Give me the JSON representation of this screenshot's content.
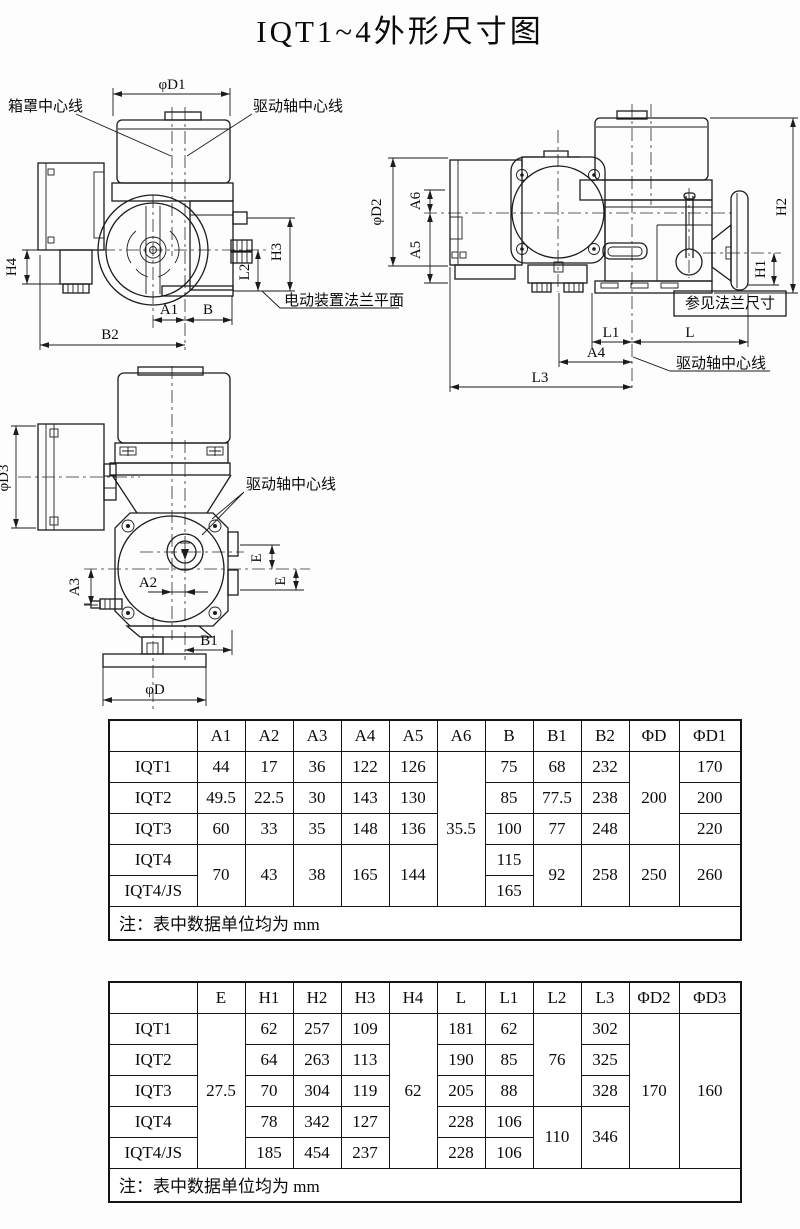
{
  "title": "IQT1~4外形尺寸图",
  "drawing": {
    "front": {
      "d1": "φD1",
      "box_centerline": "箱罩中心线",
      "shaft_centerline": "驱动轴中心线",
      "h4": "H4",
      "h3": "H3",
      "l2": "L2",
      "a1": "A1",
      "b": "B",
      "b2": "B2",
      "flange_plane": "电动装置法兰平面"
    },
    "side": {
      "d2": "φD2",
      "a6": "A6",
      "a5": "A5",
      "h2": "H2",
      "h1": "H1",
      "see_flange": "参见法兰尺寸",
      "l1": "L1",
      "l": "L",
      "a4": "A4",
      "l3": "L3",
      "shaft_centerline": "驱动轴中心线"
    },
    "top": {
      "d3": "φD3",
      "shaft_centerline": "驱动轴中心线",
      "e_upper": "E",
      "e_lower": "E",
      "a3": "A3",
      "a2": "A2",
      "b1": "B1",
      "d": "φD"
    }
  },
  "table1": {
    "headers": [
      "",
      "A1",
      "A2",
      "A3",
      "A4",
      "A5",
      "A6",
      "B",
      "B1",
      "B2",
      "ΦD",
      "ΦD1"
    ],
    "rows": [
      [
        {
          "v": "IQT1"
        },
        {
          "v": "44"
        },
        {
          "v": "17"
        },
        {
          "v": "36"
        },
        {
          "v": "122"
        },
        {
          "v": "126"
        },
        {
          "v": "35.5",
          "rs": 5
        },
        {
          "v": "75"
        },
        {
          "v": "68"
        },
        {
          "v": "232"
        },
        {
          "v": "200",
          "rs": 3
        },
        {
          "v": "170"
        }
      ],
      [
        {
          "v": "IQT2"
        },
        {
          "v": "49.5"
        },
        {
          "v": "22.5"
        },
        {
          "v": "30"
        },
        {
          "v": "143"
        },
        {
          "v": "130"
        },
        {
          "v": "85"
        },
        {
          "v": "77.5"
        },
        {
          "v": "238"
        },
        {
          "v": "200"
        }
      ],
      [
        {
          "v": "IQT3"
        },
        {
          "v": "60"
        },
        {
          "v": "33"
        },
        {
          "v": "35"
        },
        {
          "v": "148"
        },
        {
          "v": "136"
        },
        {
          "v": "100"
        },
        {
          "v": "77"
        },
        {
          "v": "248"
        },
        {
          "v": "220"
        }
      ],
      [
        {
          "v": "IQT4"
        },
        {
          "v": "70",
          "rs": 2
        },
        {
          "v": "43",
          "rs": 2
        },
        {
          "v": "38",
          "rs": 2
        },
        {
          "v": "165",
          "rs": 2
        },
        {
          "v": "144",
          "rs": 2
        },
        {
          "v": "115"
        },
        {
          "v": "92",
          "rs": 2
        },
        {
          "v": "258",
          "rs": 2
        },
        {
          "v": "250",
          "rs": 2
        },
        {
          "v": "260",
          "rs": 2
        }
      ],
      [
        {
          "v": "IQT4/JS"
        },
        {
          "v": "165"
        }
      ]
    ],
    "note": "注：表中数据单位均为 mm"
  },
  "table2": {
    "headers": [
      "",
      "E",
      "H1",
      "H2",
      "H3",
      "H4",
      "L",
      "L1",
      "L2",
      "L3",
      "ΦD2",
      "ΦD3"
    ],
    "rows": [
      [
        {
          "v": "IQT1"
        },
        {
          "v": "27.5",
          "rs": 5
        },
        {
          "v": "62"
        },
        {
          "v": "257"
        },
        {
          "v": "109"
        },
        {
          "v": "62",
          "rs": 5
        },
        {
          "v": "181"
        },
        {
          "v": "62"
        },
        {
          "v": "76",
          "rs": 3
        },
        {
          "v": "302"
        },
        {
          "v": "170",
          "rs": 5
        },
        {
          "v": "160",
          "rs": 5
        }
      ],
      [
        {
          "v": "IQT2"
        },
        {
          "v": "64"
        },
        {
          "v": "263"
        },
        {
          "v": "113"
        },
        {
          "v": "190"
        },
        {
          "v": "85"
        },
        {
          "v": "325"
        }
      ],
      [
        {
          "v": "IQT3"
        },
        {
          "v": "70"
        },
        {
          "v": "304"
        },
        {
          "v": "119"
        },
        {
          "v": "205"
        },
        {
          "v": "88"
        },
        {
          "v": "328"
        }
      ],
      [
        {
          "v": "IQT4"
        },
        {
          "v": "78"
        },
        {
          "v": "342"
        },
        {
          "v": "127"
        },
        {
          "v": "228"
        },
        {
          "v": "106"
        },
        {
          "v": "110",
          "rs": 2
        },
        {
          "v": "346",
          "rs": 2
        }
      ],
      [
        {
          "v": "IQT4/JS"
        },
        {
          "v": "185"
        },
        {
          "v": "454"
        },
        {
          "v": "237"
        },
        {
          "v": "228"
        },
        {
          "v": "106"
        }
      ]
    ],
    "note": "注：表中数据单位均为 mm"
  }
}
